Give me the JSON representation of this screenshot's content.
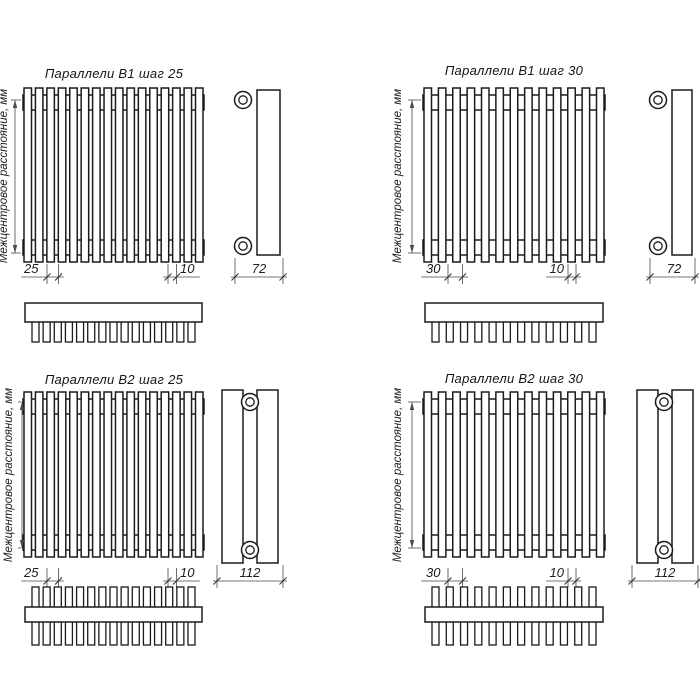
{
  "page": {
    "background": "#ffffff",
    "line_color": "#1b1b1b",
    "dim_line_color": "#4a4a4a"
  },
  "shared": {
    "vertical_dim_label": "Межцентровое расстояние, мм"
  },
  "panels": [
    {
      "id": "b1-step25",
      "title": "Параллели В1 шаг 25",
      "series": "В1",
      "step_label": "25",
      "tube_width_label": "10",
      "depth_label": "72",
      "front_tube_count": 16,
      "top_view_tube_count": 15,
      "rows_of_tubes": 1
    },
    {
      "id": "b1-step30",
      "title": "Параллели В1 шаг 30",
      "series": "В1",
      "step_label": "30",
      "tube_width_label": "10",
      "depth_label": "72",
      "front_tube_count": 13,
      "top_view_tube_count": 12,
      "rows_of_tubes": 1
    },
    {
      "id": "b2-step25",
      "title": "Параллели В2 шаг 25",
      "series": "В2",
      "step_label": "25",
      "tube_width_label": "10",
      "depth_label": "112",
      "front_tube_count": 16,
      "top_view_tube_count": 15,
      "rows_of_tubes": 2
    },
    {
      "id": "b2-step30",
      "title": "Параллели В2 шаг 30",
      "series": "В2",
      "step_label": "30",
      "tube_width_label": "10",
      "depth_label": "112",
      "front_tube_count": 13,
      "top_view_tube_count": 12,
      "rows_of_tubes": 2
    }
  ]
}
